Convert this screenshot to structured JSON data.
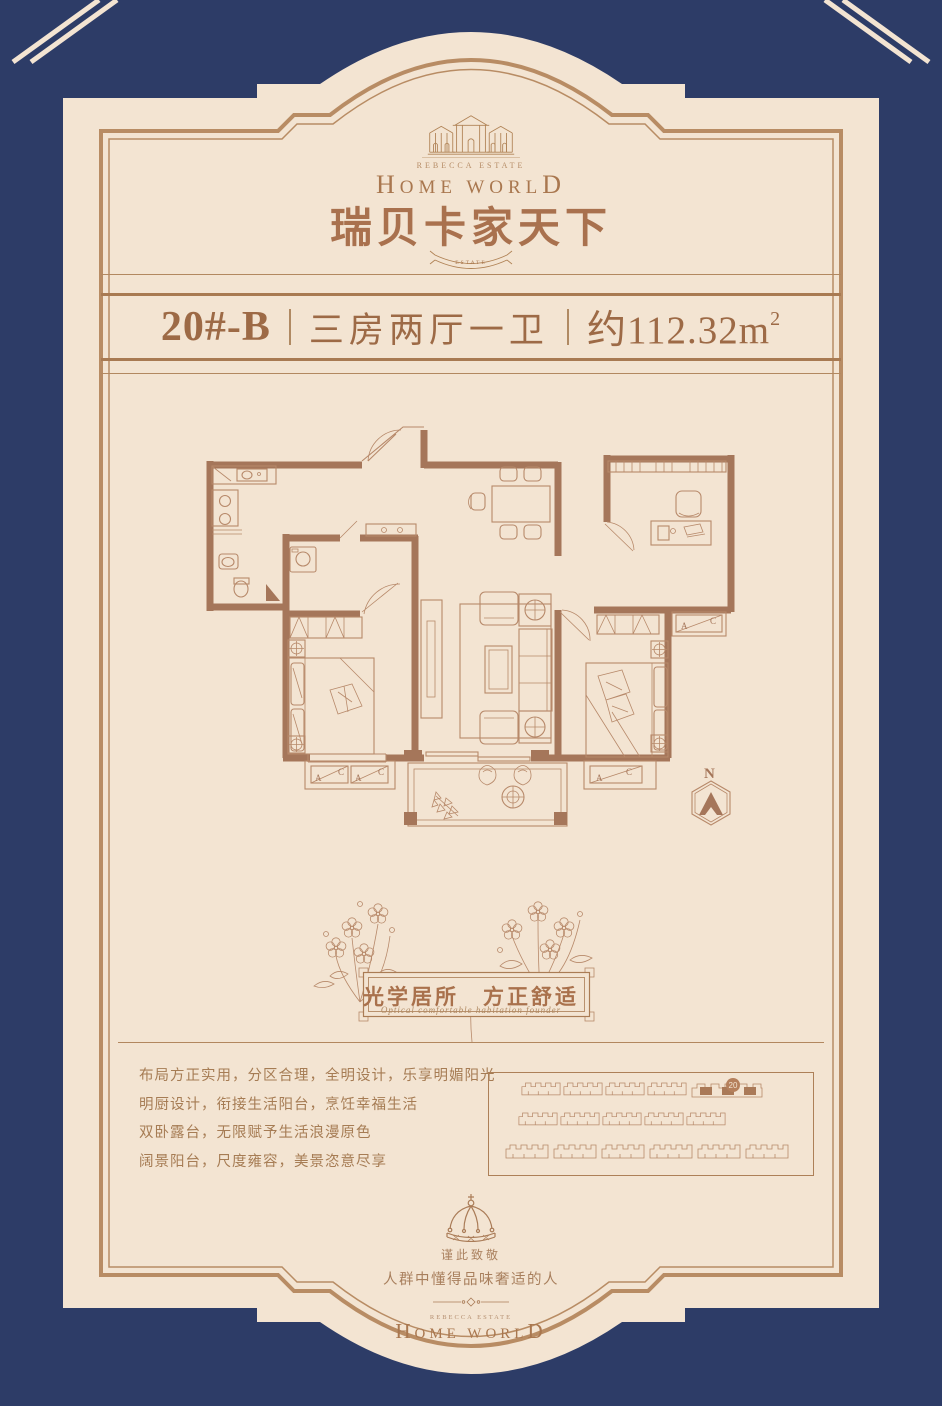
{
  "colors": {
    "background": "#2d3c67",
    "card": "#f3e4d2",
    "border": "#b88c64",
    "accent": "#a9714e",
    "text_brown": "#a67c54",
    "wall": "#a5765a",
    "banner_text": "#9d6a46"
  },
  "brand": {
    "estate": "REBECCA ESTATE",
    "first": "H",
    "middle": "OME WORL",
    "last": "D",
    "cn": "瑞贝卡家天下",
    "ribbon": "ESTATE"
  },
  "banner": {
    "unit": "20#-B",
    "layout": "三房两厅一卫",
    "area": "约112.32m",
    "area_sup": "2"
  },
  "floorplan": {
    "compass": "N",
    "ac_a": "A",
    "ac_c": "C"
  },
  "slogan": {
    "cn": "光学居所　方正舒适",
    "en": "Optical comfortable habitation founder"
  },
  "features": {
    "lines": [
      "布局方正实用，分区合理，全明设计，乐享明媚阳光",
      "明厨设计，衔接生活阳台，烹饪幸福生活",
      "双卧露台，无限赋予生活浪漫原色",
      "阔景阳台，尺度雍容，美景恣意尽享"
    ]
  },
  "siteplan": {
    "badge": "20"
  },
  "footer": {
    "tribute": "谨此致敬",
    "audience": "人群中懂得品味奢适的人"
  }
}
